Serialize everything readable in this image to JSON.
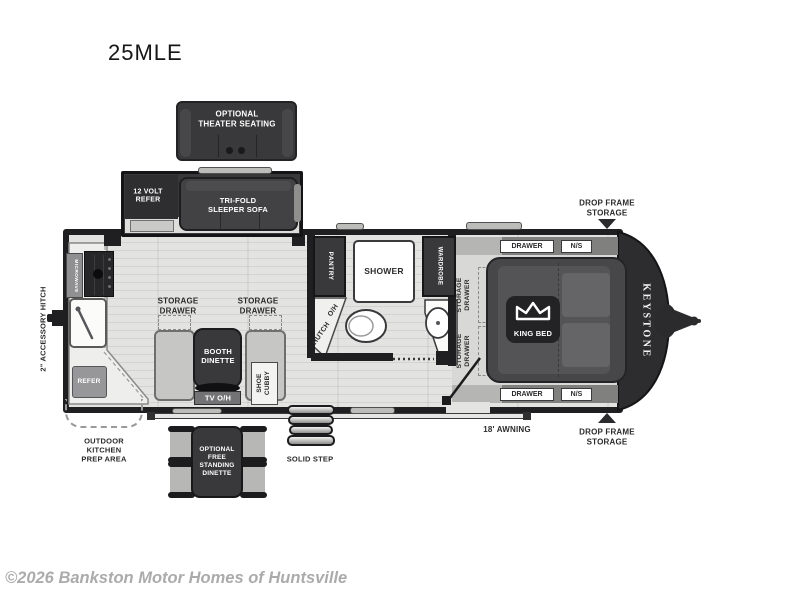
{
  "title": "25MLE",
  "footer": {
    "copyright": "©2026 Bankston Motor Homes of Huntsville"
  },
  "options": {
    "theater_seating": "OPTIONAL\nTHEATER SEATING",
    "free_standing_dinette": "OPTIONAL\nFREE\nSTANDING\nDINETTE"
  },
  "slideout": {
    "refer": "12 VOLT\nREFER",
    "sofa": "TRI-FOLD\nSLEEPER SOFA"
  },
  "kitchen": {
    "microwave": "MICROWAVE",
    "refer": "REFER",
    "storage_drawer_left": "STORAGE\nDRAWER",
    "storage_drawer_right": "STORAGE\nDRAWER",
    "outdoor_prep": "OUTDOOR\nKITCHEN\nPREP AREA"
  },
  "dinette": {
    "booth": "BOOTH\nDINETTE",
    "tv_overhead": "TV O/H",
    "shoe_cubby": "SHOE\nCUBBY"
  },
  "bathroom": {
    "pantry": "PANTRY",
    "overhead": "O/H",
    "hutch": "HUTCH",
    "shower": "SHOWER",
    "wardrobe": "WARDROBE"
  },
  "bedroom": {
    "king_bed": "KING BED",
    "drawer_top": "DRAWER",
    "night_stand_top": "N/S",
    "drawer_bottom": "DRAWER",
    "night_stand_bottom": "N/S",
    "storage_drawer_upper": "STORAGE\nDRAWER",
    "storage_drawer_lower": "STORAGE\nDRAWER"
  },
  "exterior": {
    "accessory_hitch": "2\" ACCESSORY HITCH",
    "brand": "KEYSTONE",
    "awning": "18'  AWNING",
    "solid_step": "SOLID STEP",
    "drop_frame_storage_front": "DROP FRAME\nSTORAGE",
    "drop_frame_storage_rear": "DROP FRAME\nSTORAGE"
  },
  "colors": {
    "wall": "#1f1f21",
    "furniture": "#39393b",
    "floor": "#e3e3e1",
    "counter": "#eeeeec",
    "accent_gray": "#98989a",
    "label_dark": "#2b2b2d"
  }
}
